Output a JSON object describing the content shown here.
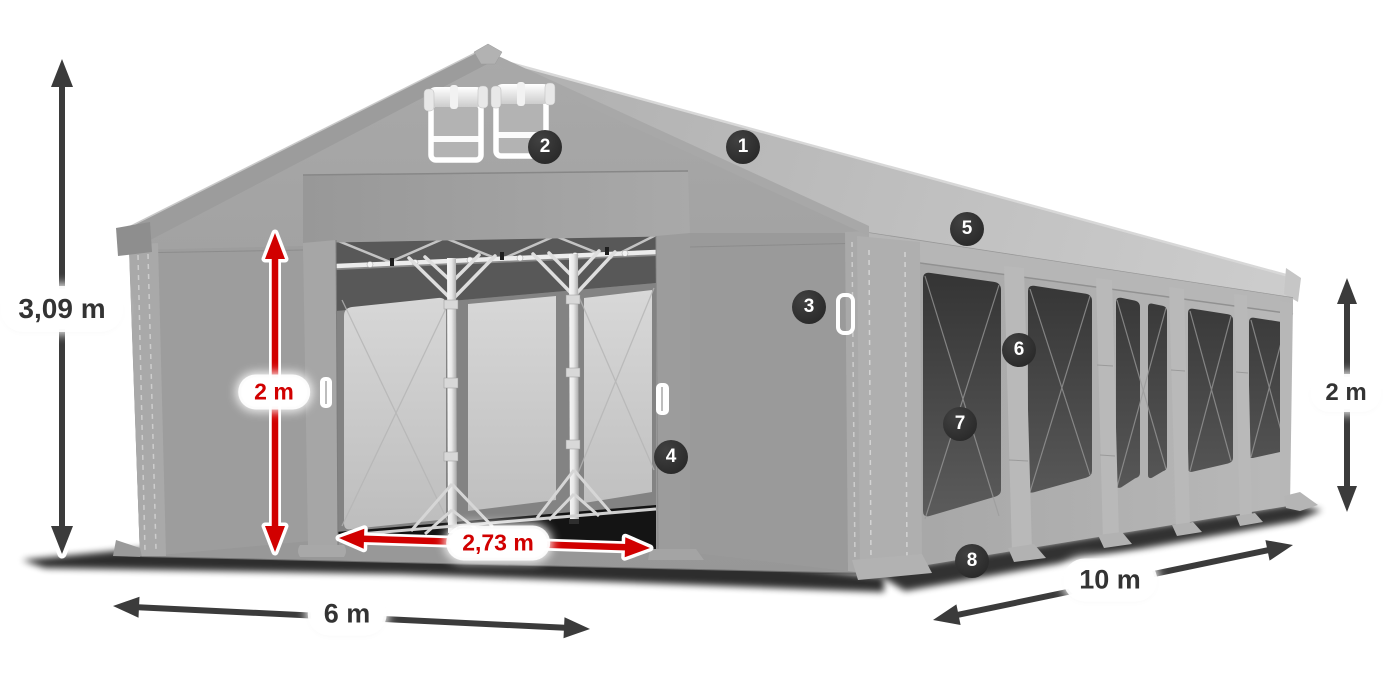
{
  "dimensions": {
    "total_height": "3,09 m",
    "entrance_height": "2 m",
    "entrance_width": "2,73 m",
    "front_width": "6 m",
    "side_length": "10 m",
    "side_wall_height": "2 m"
  },
  "markers": [
    "1",
    "2",
    "3",
    "4",
    "5",
    "6",
    "7",
    "8"
  ],
  "colors": {
    "background": "#ffffff",
    "dimension_red": "#d10000",
    "dimension_dark": "#3b3b3b",
    "marker_badge": "#2b2b2b",
    "label_text": "#333333",
    "tent_grey": "#a2a2a2"
  }
}
